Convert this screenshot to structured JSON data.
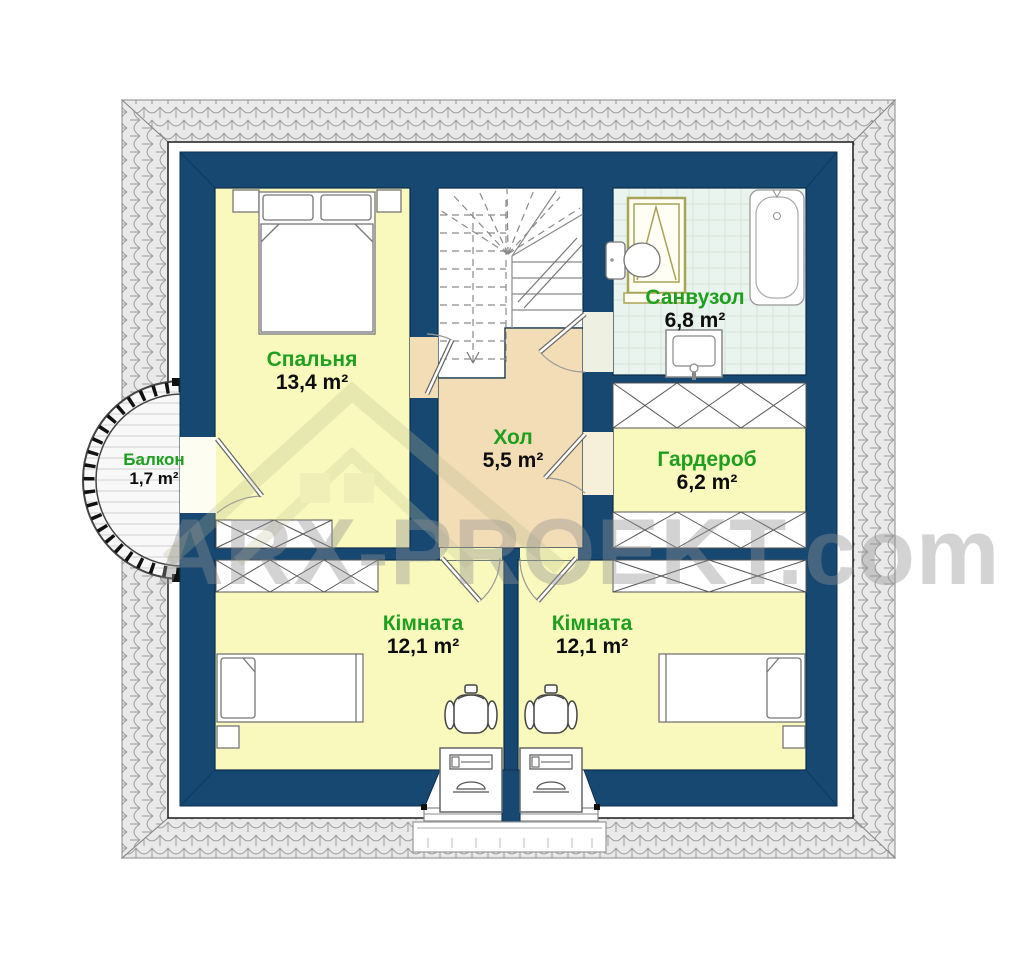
{
  "watermark": "ARX-PROEKT.com",
  "rooms": [
    {
      "id": "bedroom",
      "name": "Спальня",
      "area": "13,4 m²"
    },
    {
      "id": "bathroom",
      "name": "Санвузол",
      "area": "6,8 m²"
    },
    {
      "id": "hall",
      "name": "Хол",
      "area": "5,5 m²"
    },
    {
      "id": "wardrobe",
      "name": "Гардероб",
      "area": "6,2 m²"
    },
    {
      "id": "balcony",
      "name": "Балкон",
      "area": "1,7 m²"
    },
    {
      "id": "room_left",
      "name": "Кімната",
      "area": "12,1 m²"
    },
    {
      "id": "room_right",
      "name": "Кімната",
      "area": "12,1 m²"
    }
  ],
  "icons": [
    "roof-tiles-pattern",
    "stairs-icon",
    "double-bed-icon",
    "single-bed-icon",
    "nightstand-icon",
    "desk-icon",
    "office-chair-icon",
    "wardrobe-cabinet-icon",
    "bathtub-icon",
    "toilet-icon",
    "washbasin-icon",
    "roof-window-icon",
    "balcony-railing-icon",
    "dormer-window-icon",
    "window-sill-icon"
  ],
  "colors": {
    "wall": "#174872",
    "room_floor": "#f9f9bd",
    "hall_floor": "#f3ddb6",
    "bathroom_floor": "#e9f4ee",
    "roof_tile": "#e9e9e9",
    "label_green": "#1ea01e",
    "area_text": "#0d0d0d",
    "watermark_gray": "#919191"
  }
}
